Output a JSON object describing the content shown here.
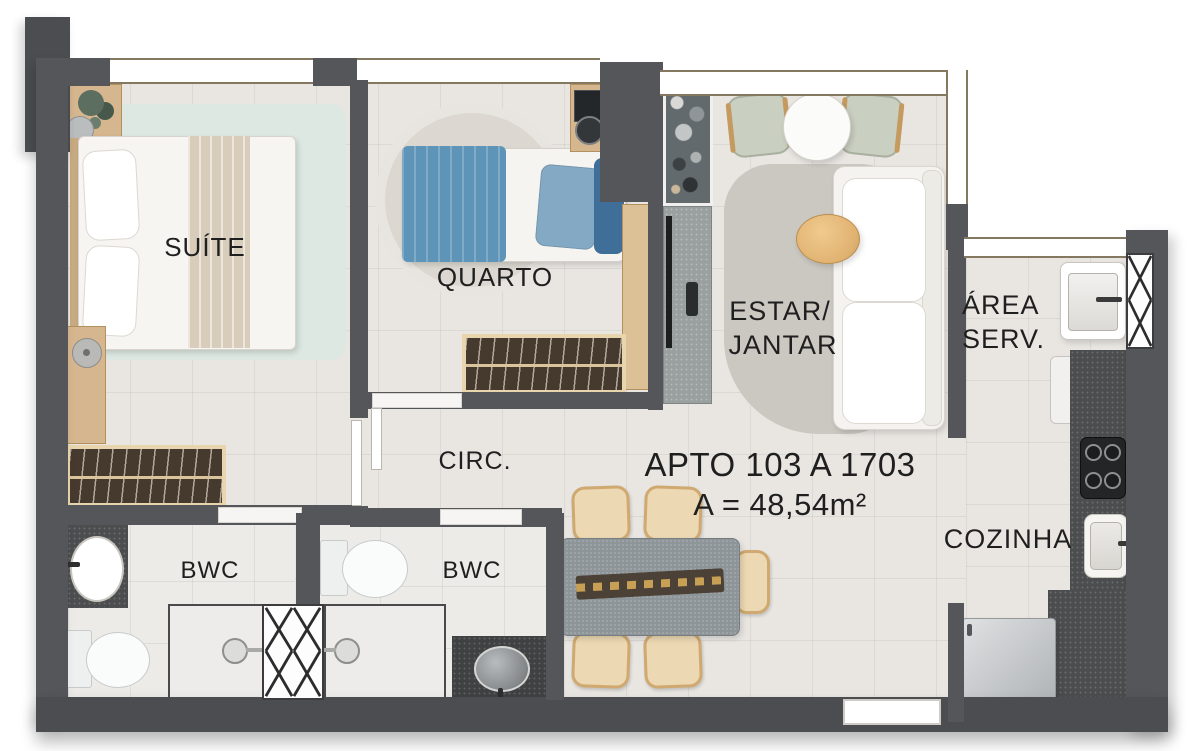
{
  "plan": {
    "title": "APTO 103 A 1703",
    "area_text": "A = 48,54m²",
    "rooms": {
      "suite": "SUÍTE",
      "quarto": "QUARTO",
      "circ": "CIRC.",
      "bwc_suite": "BWC",
      "bwc_social": "BWC",
      "estar_line1": "ESTAR/",
      "estar_line2": "JANTAR",
      "serv_line1": "ÁREA",
      "serv_line2": "SERV.",
      "cozinha": "COZINHA"
    },
    "colors": {
      "wall": "#54565a",
      "floor": "#e9e6e2",
      "suite_rug": "#dde8e2",
      "quarto_rug": "#dcd8d1",
      "living_rug": "#cbc8c2",
      "blanket_blue": "#5d94b7",
      "wood": "#d6b68e",
      "dark_counter": "#4b4d4f",
      "sofa": "#f4f3f0",
      "dining_table": "#8d9598",
      "dining_chair": "#ecd8b2",
      "label_text": "#1f1f20"
    }
  }
}
